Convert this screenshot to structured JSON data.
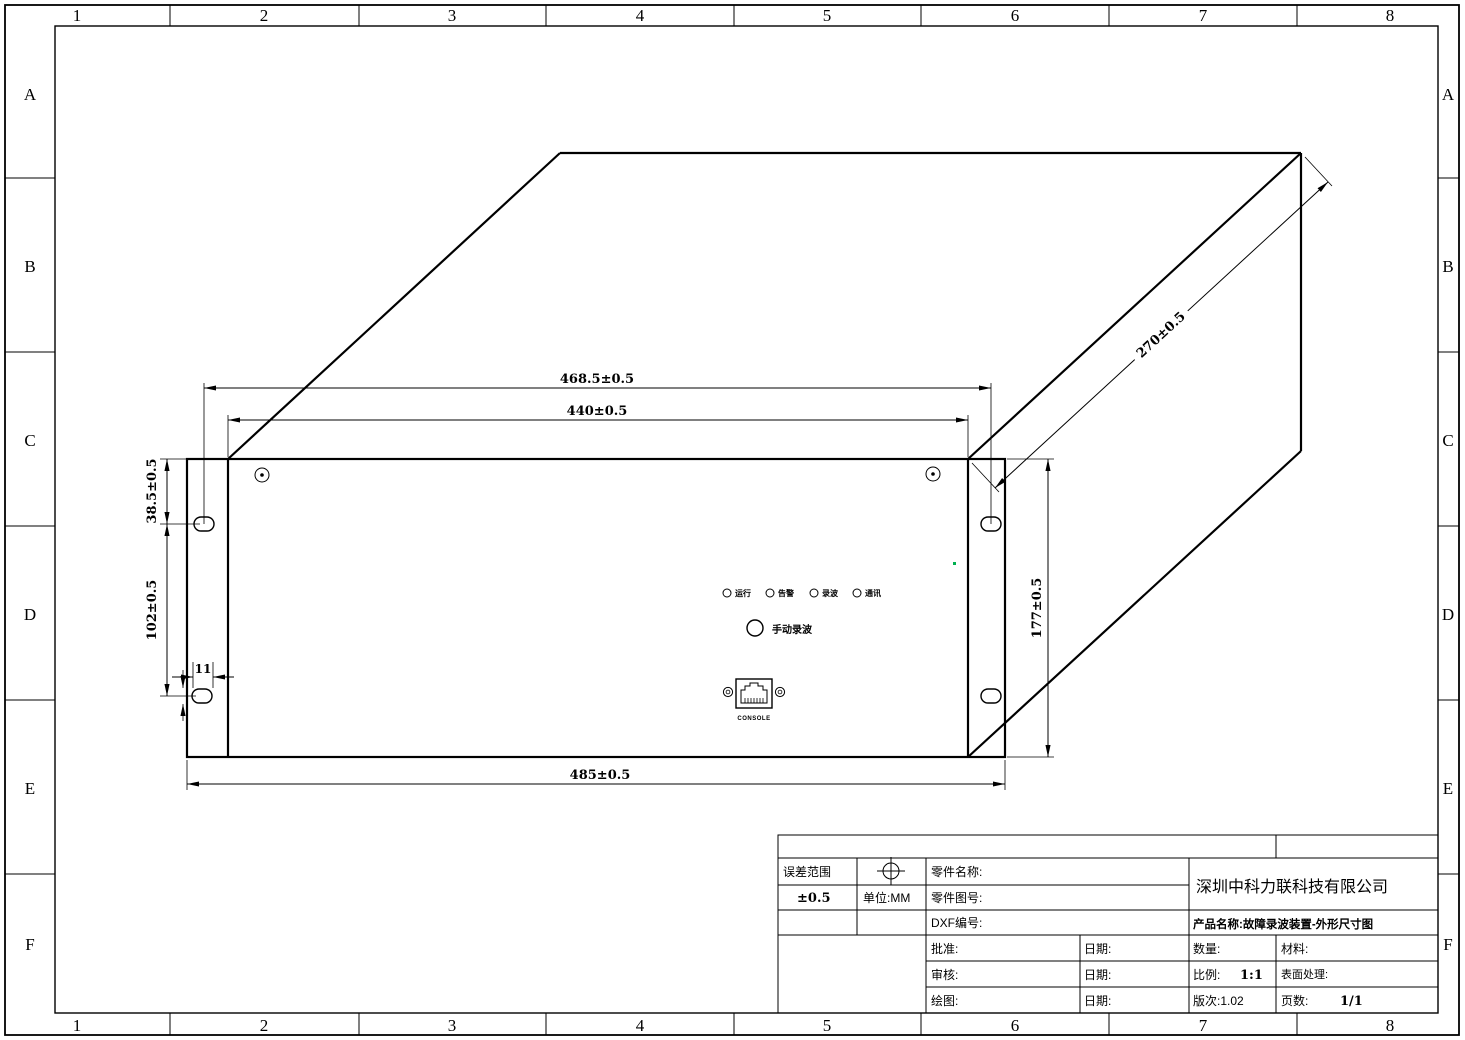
{
  "grid": {
    "cols": [
      "1",
      "2",
      "3",
      "4",
      "5",
      "6",
      "7",
      "8"
    ],
    "rows": [
      "A",
      "B",
      "C",
      "D",
      "E",
      "F"
    ]
  },
  "drawing": {
    "dims": {
      "slot_span_width": "468.5±0.5",
      "body_width": "440±0.5",
      "total_width": "485±0.5",
      "panel_height": "177±0.5",
      "top_to_slot": "38.5±0.5",
      "slot_to_slot": "102±0.5",
      "slot_offset": "11",
      "depth": "270±0.5"
    },
    "panel": {
      "leds": [
        "运行",
        "告警",
        "录波",
        "通讯"
      ],
      "record_button_label": "手动录波",
      "console_label": "CONSOLE"
    },
    "colors": {
      "line": "#000000",
      "marker_green": "#00b050"
    }
  },
  "title_block": {
    "tolerance_label": "误差范围",
    "tolerance_value": "±0.5",
    "unit": "单位:MM",
    "part_name": "零件名称:",
    "part_no": "零件图号:",
    "dxf_no": "DXF编号:",
    "approve": "批准:",
    "review": "审核:",
    "draw": "绘图:",
    "date1": "日期:",
    "date2": "日期:",
    "date3": "日期:",
    "qty": "数量:",
    "material": "材料:",
    "scale_label": "比例:",
    "scale_value": "1:1",
    "surface": "表面处理:",
    "rev": "版次:1.02",
    "pages_label": "页数:",
    "pages_value": "1/1",
    "company": "深圳中科力联科技有限公司",
    "product": "产品名称:故障录波装置-外形尺寸图"
  }
}
